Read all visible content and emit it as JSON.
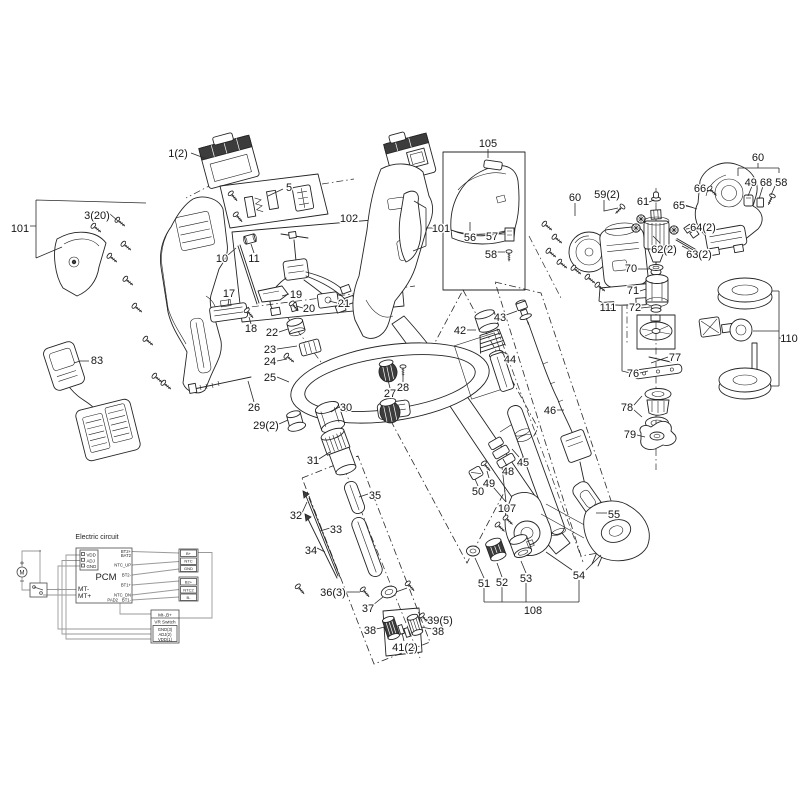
{
  "colors": {
    "ink": "#242424",
    "wire": "#9a9a9a",
    "background": "#ffffff",
    "dark_part": "#3c3c3c"
  },
  "diagram": {
    "labels": [
      {
        "t": "1(2)",
        "x": 178,
        "y": 153
      },
      {
        "t": "3(20)",
        "x": 97,
        "y": 215
      },
      {
        "t": "101",
        "x": 20,
        "y": 228
      },
      {
        "t": "5",
        "x": 289,
        "y": 187
      },
      {
        "t": "102",
        "x": 349,
        "y": 218
      },
      {
        "t": "101",
        "x": 441,
        "y": 228
      },
      {
        "t": "105",
        "x": 488,
        "y": 143
      },
      {
        "t": "56",
        "x": 470,
        "y": 237
      },
      {
        "t": "57",
        "x": 492,
        "y": 236
      },
      {
        "t": "58",
        "x": 491,
        "y": 254
      },
      {
        "t": "60",
        "x": 575,
        "y": 197
      },
      {
        "t": "59(2)",
        "x": 607,
        "y": 194
      },
      {
        "t": "61",
        "x": 643,
        "y": 201
      },
      {
        "t": "62(2)",
        "x": 664,
        "y": 249
      },
      {
        "t": "63(2)",
        "x": 699,
        "y": 254
      },
      {
        "t": "64(2)",
        "x": 703,
        "y": 227
      },
      {
        "t": "65",
        "x": 679,
        "y": 205
      },
      {
        "t": "66",
        "x": 700,
        "y": 188
      },
      {
        "t": "60",
        "x": 758,
        "y": 157
      },
      {
        "t": "49 68 58",
        "x": 766,
        "y": 182
      },
      {
        "t": "70",
        "x": 631,
        "y": 268
      },
      {
        "t": "71",
        "x": 633,
        "y": 290
      },
      {
        "t": "111",
        "x": 608,
        "y": 307
      },
      {
        "t": "72",
        "x": 635,
        "y": 307
      },
      {
        "t": "77",
        "x": 675,
        "y": 357
      },
      {
        "t": "76",
        "x": 633,
        "y": 373
      },
      {
        "t": "110",
        "x": 789,
        "y": 338
      },
      {
        "t": "78",
        "x": 627,
        "y": 407
      },
      {
        "t": "79",
        "x": 630,
        "y": 434
      },
      {
        "t": "83",
        "x": 97,
        "y": 360
      },
      {
        "t": "10",
        "x": 222,
        "y": 258
      },
      {
        "t": "11",
        "x": 254,
        "y": 258
      },
      {
        "t": "17",
        "x": 229,
        "y": 293
      },
      {
        "t": "18",
        "x": 251,
        "y": 328
      },
      {
        "t": "19",
        "x": 296,
        "y": 294
      },
      {
        "t": "20",
        "x": 309,
        "y": 308
      },
      {
        "t": "21",
        "x": 344,
        "y": 303
      },
      {
        "t": "22",
        "x": 272,
        "y": 332
      },
      {
        "t": "23",
        "x": 270,
        "y": 349
      },
      {
        "t": "24",
        "x": 270,
        "y": 361
      },
      {
        "t": "25",
        "x": 270,
        "y": 377
      },
      {
        "t": "26",
        "x": 254,
        "y": 407
      },
      {
        "t": "27",
        "x": 390,
        "y": 393
      },
      {
        "t": "28",
        "x": 403,
        "y": 387
      },
      {
        "t": "29(2)",
        "x": 266,
        "y": 425
      },
      {
        "t": "30",
        "x": 346,
        "y": 407
      },
      {
        "t": "31",
        "x": 313,
        "y": 460
      },
      {
        "t": "35",
        "x": 375,
        "y": 495
      },
      {
        "t": "32",
        "x": 296,
        "y": 515
      },
      {
        "t": "33",
        "x": 336,
        "y": 529
      },
      {
        "t": "34",
        "x": 311,
        "y": 550
      },
      {
        "t": "36(3)",
        "x": 333,
        "y": 592
      },
      {
        "t": "37",
        "x": 368,
        "y": 608
      },
      {
        "t": "38",
        "x": 370,
        "y": 630
      },
      {
        "t": "39(5)",
        "x": 440,
        "y": 620
      },
      {
        "t": "38",
        "x": 438,
        "y": 631
      },
      {
        "t": "41(2)",
        "x": 405,
        "y": 647
      },
      {
        "t": "42",
        "x": 460,
        "y": 330
      },
      {
        "t": "43",
        "x": 500,
        "y": 317
      },
      {
        "t": "44",
        "x": 510,
        "y": 359
      },
      {
        "t": "46",
        "x": 550,
        "y": 410
      },
      {
        "t": "45",
        "x": 523,
        "y": 462
      },
      {
        "t": "48",
        "x": 508,
        "y": 471
      },
      {
        "t": "49",
        "x": 489,
        "y": 483
      },
      {
        "t": "50",
        "x": 478,
        "y": 491
      },
      {
        "t": "107",
        "x": 507,
        "y": 508
      },
      {
        "t": "55",
        "x": 614,
        "y": 514
      },
      {
        "t": "51",
        "x": 484,
        "y": 583
      },
      {
        "t": "52",
        "x": 502,
        "y": 582
      },
      {
        "t": "53",
        "x": 526,
        "y": 578
      },
      {
        "t": "54",
        "x": 579,
        "y": 575
      },
      {
        "t": "108",
        "x": 533,
        "y": 610
      }
    ]
  },
  "circuit": {
    "title": "Electric circuit",
    "motor_symbol": "M",
    "pcm": {
      "name": "PCM",
      "left_pins": [
        "VDD",
        "ADJ",
        "GND"
      ],
      "mt_minus": "MT-",
      "mt_plus": "MT+",
      "right_pins": [
        "BT2+",
        "BAT2",
        "NTC_UP",
        "BT2-",
        "BT1+",
        "NTC_DN",
        "BT1-"
      ],
      "pad": "PAD2"
    },
    "conn1_pins": [
      "B+",
      "NTC",
      "GND"
    ],
    "conn2_pins": [
      "B2+",
      "NTC2",
      "B-"
    ],
    "vr_box": {
      "header": "Mt-,B+",
      "line1": "VR Switch",
      "pins": [
        "GND(3)",
        "ADJ(2)",
        "VDD(1)"
      ]
    }
  }
}
